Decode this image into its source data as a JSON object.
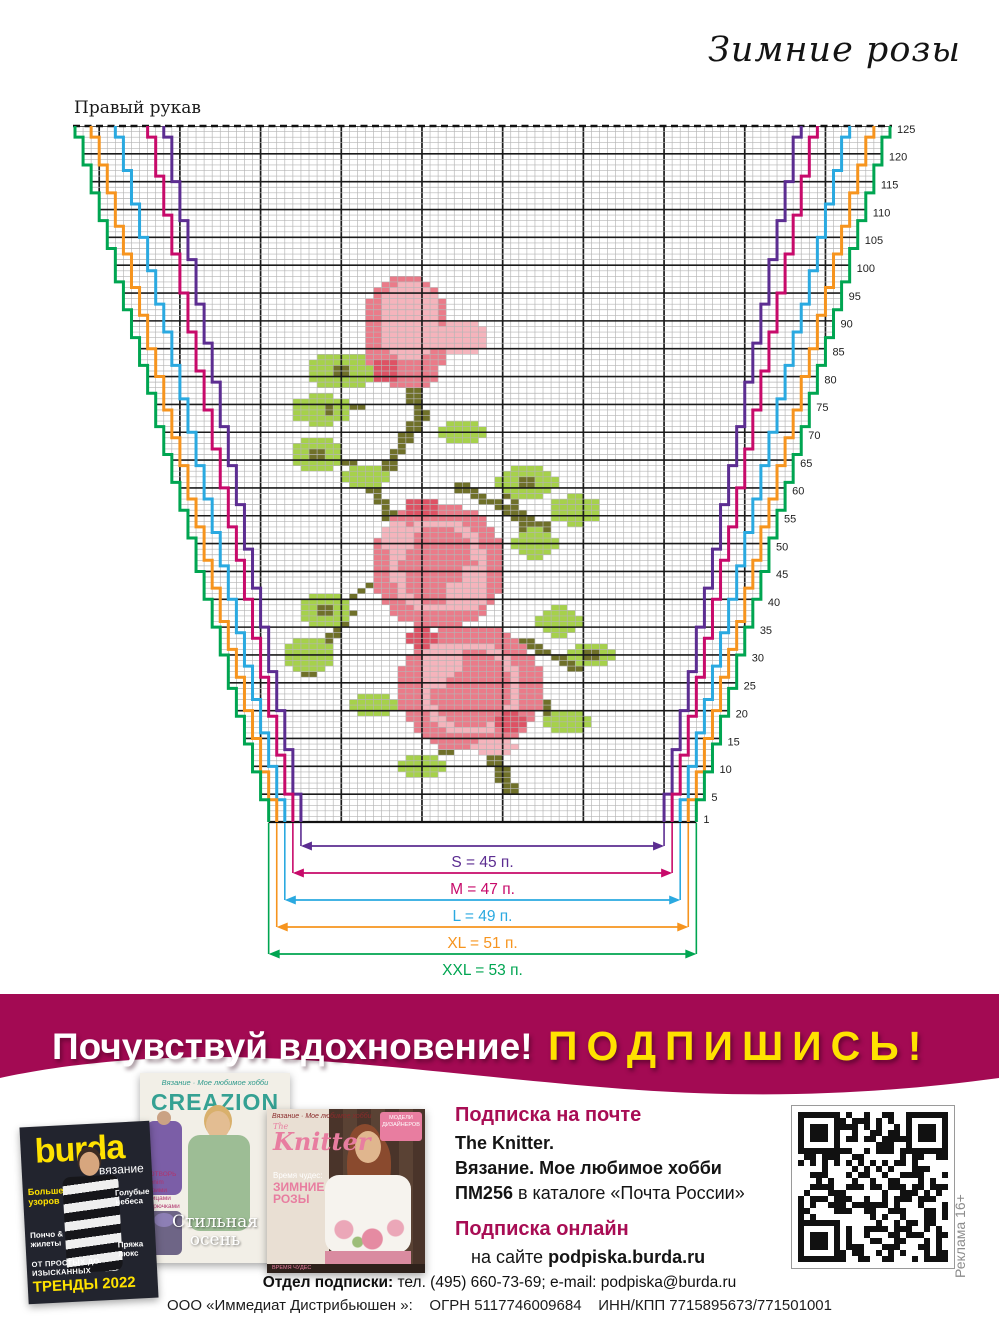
{
  "page_title": "Зимние розы",
  "chart": {
    "type": "knitting-colorwork-chart",
    "label": "Правый рукав",
    "rows": 125,
    "cols": 101,
    "row_label_every": 5,
    "row_label_first": 1,
    "sizes": [
      {
        "name": "S",
        "stitches": 45,
        "increases": 17,
        "label": "S = 45 п.",
        "color": "#5c2d91"
      },
      {
        "name": "M",
        "stitches": 47,
        "increases": 18,
        "label": "M = 47 п.",
        "color": "#c70a6a"
      },
      {
        "name": "L",
        "stitches": 49,
        "increases": 21,
        "label": "L = 49 п.",
        "color": "#2aa9e0"
      },
      {
        "name": "XL",
        "stitches": 51,
        "increases": 23,
        "label": "XL = 51 п.",
        "color": "#f6941e"
      },
      {
        "name": "XXL",
        "stitches": 53,
        "increases": 24,
        "label": "XXL = 53 п.",
        "color": "#00a551"
      }
    ],
    "motif": {
      "palette": {
        "l": "#f5b4bc",
        "p": "#ea7b89",
        "r": "#de5264",
        "g": "#a6d14b",
        "o": "#6f7029"
      },
      "shapes": [
        [
          "s",
          "o",
          41,
          80,
          43,
          73,
          1.4
        ],
        [
          "s",
          "o",
          43,
          73,
          37,
          60,
          1.4
        ],
        [
          "s",
          "o",
          37,
          60,
          41,
          50,
          1.4
        ],
        [
          "s",
          "o",
          30,
          77,
          36,
          74,
          1.0
        ],
        [
          "s",
          "o",
          29,
          67,
          36,
          63,
          1.0
        ],
        [
          "s",
          "o",
          48,
          60,
          58,
          53,
          1.2
        ],
        [
          "s",
          "o",
          53,
          62,
          57,
          47,
          1.0
        ],
        [
          "s",
          "o",
          34,
          40,
          39,
          45,
          1.1
        ],
        [
          "s",
          "o",
          29,
          26,
          34,
          38,
          1.1
        ],
        [
          "s",
          "o",
          55,
          33,
          63,
          27,
          1.1
        ],
        [
          "s",
          "o",
          50,
          16,
          54,
          6,
          1.8
        ],
        [
          "s",
          "o",
          49,
          14,
          43,
          11,
          1.1
        ],
        [
          "s",
          "o",
          56,
          24,
          61,
          17,
          1.0
        ],
        [
          "e",
          "g",
          33,
          81,
          4,
          3.4
        ],
        [
          "e",
          "g",
          30.5,
          74,
          3.5,
          3
        ],
        [
          "e",
          "g",
          30,
          66,
          3.5,
          3.2
        ],
        [
          "e",
          "g",
          36,
          62,
          2.6,
          2.5
        ],
        [
          "e",
          "g",
          48,
          70,
          3,
          2.2
        ],
        [
          "e",
          "g",
          56,
          61,
          3.8,
          3
        ],
        [
          "e",
          "g",
          62,
          56,
          3.2,
          2.8
        ],
        [
          "e",
          "g",
          57,
          50,
          3,
          2.6
        ],
        [
          "e",
          "g",
          31,
          38,
          3.2,
          3
        ],
        [
          "e",
          "g",
          29,
          30,
          3,
          3.2
        ],
        [
          "e",
          "g",
          37,
          21,
          2.7,
          2.4
        ],
        [
          "e",
          "g",
          60,
          36,
          3,
          2.6
        ],
        [
          "e",
          "g",
          64,
          30,
          2.8,
          2.5
        ],
        [
          "e",
          "g",
          61,
          18,
          3,
          2.5
        ],
        [
          "e",
          "g",
          43,
          10,
          3,
          2.1
        ],
        [
          "e",
          "o",
          31.5,
          74,
          1,
          0.9
        ],
        [
          "e",
          "o",
          30,
          66,
          1,
          0.9
        ],
        [
          "e",
          "o",
          56,
          61,
          1.1,
          1
        ],
        [
          "e",
          "o",
          31,
          38,
          1,
          0.9
        ],
        [
          "e",
          "o",
          64,
          30,
          0.9,
          0.8
        ],
        [
          "e",
          "o",
          33,
          81,
          1,
          0.9
        ],
        [
          "e",
          "p",
          41,
          88,
          5.5,
          10
        ],
        [
          "e",
          "l",
          41.5,
          90,
          4,
          7
        ],
        [
          "e",
          "l",
          48,
          87,
          2.8,
          3.5
        ],
        [
          "e",
          "r",
          38.5,
          81,
          1.8,
          2.2
        ],
        [
          "e",
          "p",
          43,
          80.5,
          2,
          2.5
        ],
        [
          "e",
          "p",
          45,
          46,
          8.5,
          11.5
        ],
        [
          "ring",
          "l",
          45,
          46,
          6,
          8.5,
          1.4
        ],
        [
          "e",
          "l",
          48.5,
          42,
          3,
          4
        ],
        [
          "e",
          "p",
          46,
          45.5,
          2.2,
          3
        ],
        [
          "e",
          "l",
          40,
          51,
          2.2,
          3
        ],
        [
          "e",
          "r",
          43,
          56.5,
          2,
          1.8
        ],
        [
          "e",
          "p",
          49,
          24,
          9,
          11.5
        ],
        [
          "ring",
          "l",
          49,
          24,
          6.3,
          8.3,
          1.4
        ],
        [
          "e",
          "l",
          45.5,
          28,
          3,
          4
        ],
        [
          "e",
          "p",
          48,
          24,
          2.4,
          3.2
        ],
        [
          "e",
          "r",
          54,
          18,
          2,
          2.2
        ],
        [
          "e",
          "l",
          52,
          13.5,
          2.5,
          2
        ],
        [
          "e",
          "r",
          43,
          33,
          1.6,
          1.8
        ]
      ]
    }
  },
  "banner": {
    "bg": "#a30a53",
    "headline": "Почувствуй вдохновение!",
    "cta": "ПОДПИШИСЬ!",
    "cta_color": "#ffe200"
  },
  "covers": {
    "burda": {
      "logo": "burda",
      "sub": "вязание",
      "left_top": "Больше узоров",
      "left_mid": "Пончо & жилеты",
      "right_top": "Голубые небеса",
      "right_mid": "Пряжа люкс",
      "bottom_small": "ОТ ПРОСТЫХ ДО ИЗЫСКАННЫХ",
      "bottom_big": "ТРЕНДЫ 2022"
    },
    "creazion": {
      "tagline": "Вязание · Мое любимое хобби",
      "logo": "CREAZION",
      "side": [
        "СОТВОРЬ Denim",
        "своими спицами",
        "и крючками"
      ],
      "caption_1": "Стильная",
      "caption_2": "осень"
    },
    "knitter": {
      "tagline": "Вязание · Мое любимое хобби",
      "logo_prefix": "The",
      "logo": "Knitter",
      "badge_1": "МОДЕЛИ",
      "badge_2": "ДИЗАЙНЕРОВ",
      "accent": "Время чудес:",
      "headline_1": "ЗИМНИЕ",
      "headline_2": "РОЗЫ",
      "bottom_strip": "ВРЕМЯ ЧУДЕС"
    }
  },
  "subscription": {
    "post_title": "Подписка на почте",
    "line1": "The Knitter.",
    "line2": "Вязание. Мое любимое хобби",
    "line3_bold": "ПМ256",
    "line3_rest": " в каталоге «Почта России»",
    "online_title": "Подписка онлайн",
    "online_prefix": "на сайте ",
    "online_site": "podpiska.burda.ru"
  },
  "ad_note": "Реклама 16+",
  "footer": {
    "line1_bold": "Отдел подписки:",
    "line1_rest": " тел. (495) 660-73-69; e-mail: podpiska@burda.ru",
    "line2": "ООО «Иммедиат Дистрибьюшен »:    ОГРН 5117746009684    ИНН/КПП 7715895673/771501001"
  }
}
